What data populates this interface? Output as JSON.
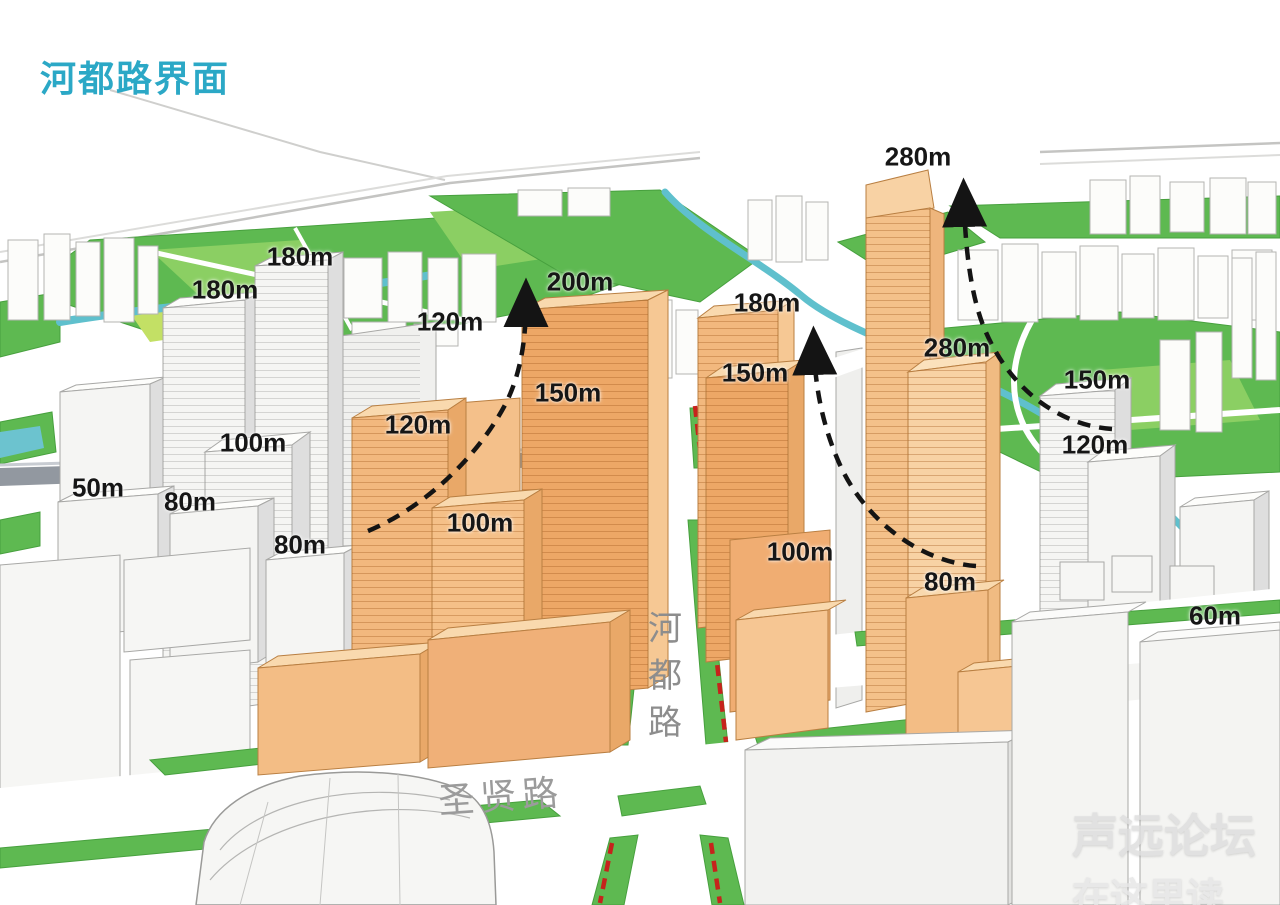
{
  "title": {
    "text": "河都路界面",
    "color": "#2ba8c6"
  },
  "roads": {
    "hedu": {
      "name": "河都路",
      "chars": [
        "河",
        "都",
        "路"
      ]
    },
    "shengxian": {
      "name": "圣贤路"
    }
  },
  "watermark": {
    "line1": "声远论坛",
    "line2": "在这里读"
  },
  "height_labels": [
    {
      "text": "180m",
      "x": 225,
      "y": 290
    },
    {
      "text": "180m",
      "x": 300,
      "y": 257
    },
    {
      "text": "120m",
      "x": 450,
      "y": 322
    },
    {
      "text": "200m",
      "x": 580,
      "y": 282
    },
    {
      "text": "150m",
      "x": 568,
      "y": 393
    },
    {
      "text": "120m",
      "x": 418,
      "y": 425
    },
    {
      "text": "100m",
      "x": 253,
      "y": 443
    },
    {
      "text": "50m",
      "x": 98,
      "y": 488
    },
    {
      "text": "80m",
      "x": 190,
      "y": 502
    },
    {
      "text": "80m",
      "x": 300,
      "y": 545
    },
    {
      "text": "100m",
      "x": 480,
      "y": 523
    },
    {
      "text": "180m",
      "x": 767,
      "y": 303
    },
    {
      "text": "150m",
      "x": 755,
      "y": 373
    },
    {
      "text": "280m",
      "x": 918,
      "y": 157
    },
    {
      "text": "280m",
      "x": 957,
      "y": 348
    },
    {
      "text": "150m",
      "x": 1097,
      "y": 380
    },
    {
      "text": "120m",
      "x": 1095,
      "y": 445
    },
    {
      "text": "100m",
      "x": 800,
      "y": 552
    },
    {
      "text": "80m",
      "x": 950,
      "y": 582
    },
    {
      "text": "60m",
      "x": 1215,
      "y": 616
    }
  ],
  "colors": {
    "accent_orange_front": "#efa966",
    "accent_orange_light": "#f6c893",
    "green": "#5eb951",
    "green_light": "#8bcf63",
    "river": "#5fc0cd",
    "red_dashed": "#c6231c",
    "arrow": "#141414",
    "road_text": "#8d8d8d"
  }
}
